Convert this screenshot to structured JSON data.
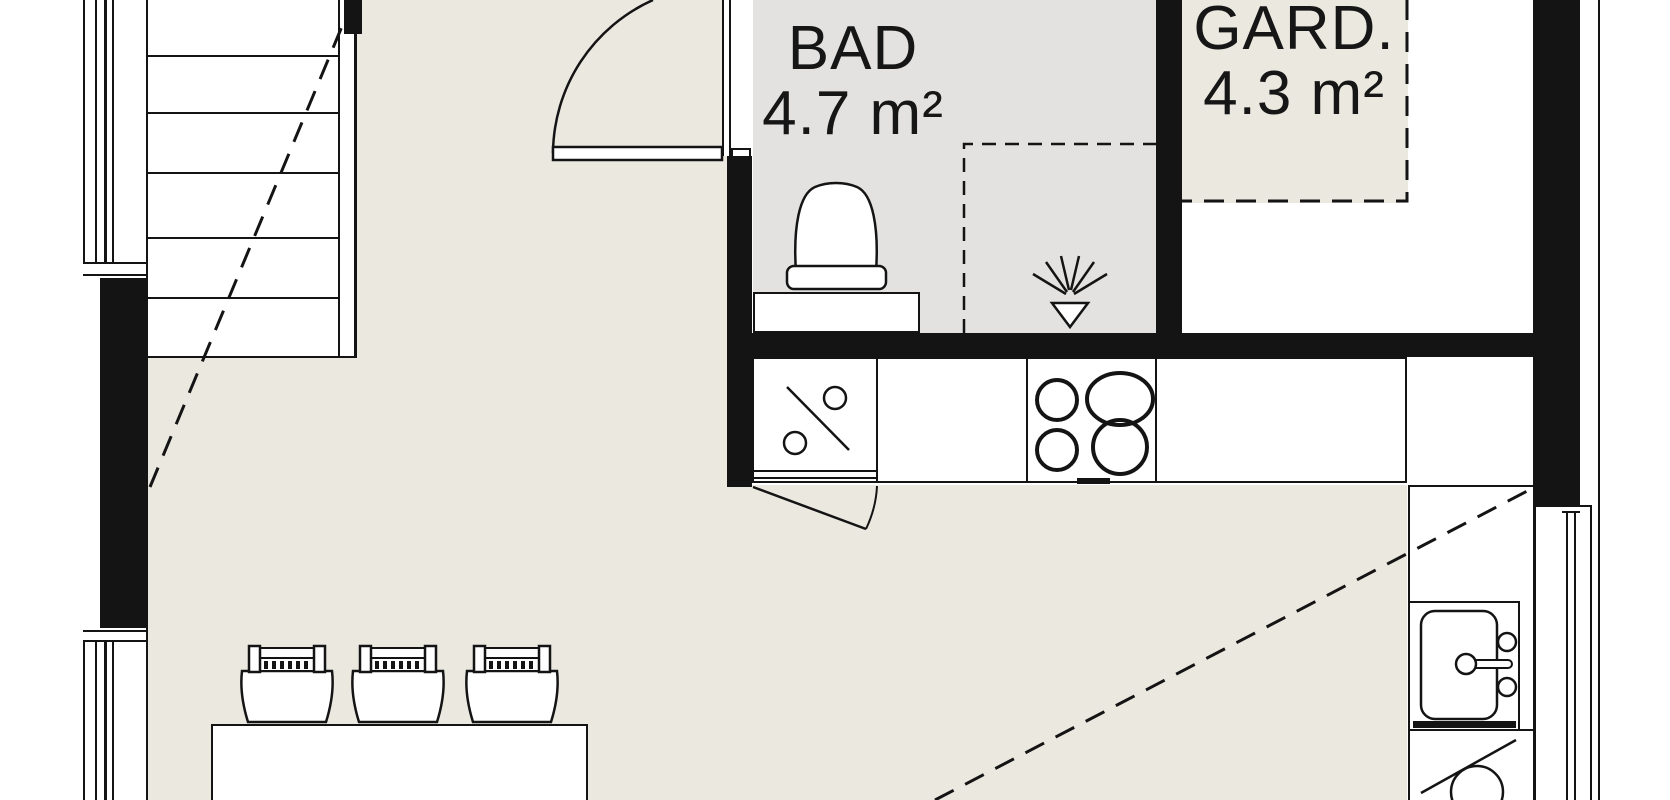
{
  "plan": {
    "rooms": [
      {
        "id": "bad",
        "label": "BAD",
        "area": "4.7 m²"
      },
      {
        "id": "gard",
        "label": "GARD.",
        "area": "4.3 m²"
      }
    ],
    "colors": {
      "floor": "#ebe8e0",
      "wet_room_floor": "#e3e2e1",
      "wall": "#141414",
      "background": "#ffffff"
    }
  }
}
